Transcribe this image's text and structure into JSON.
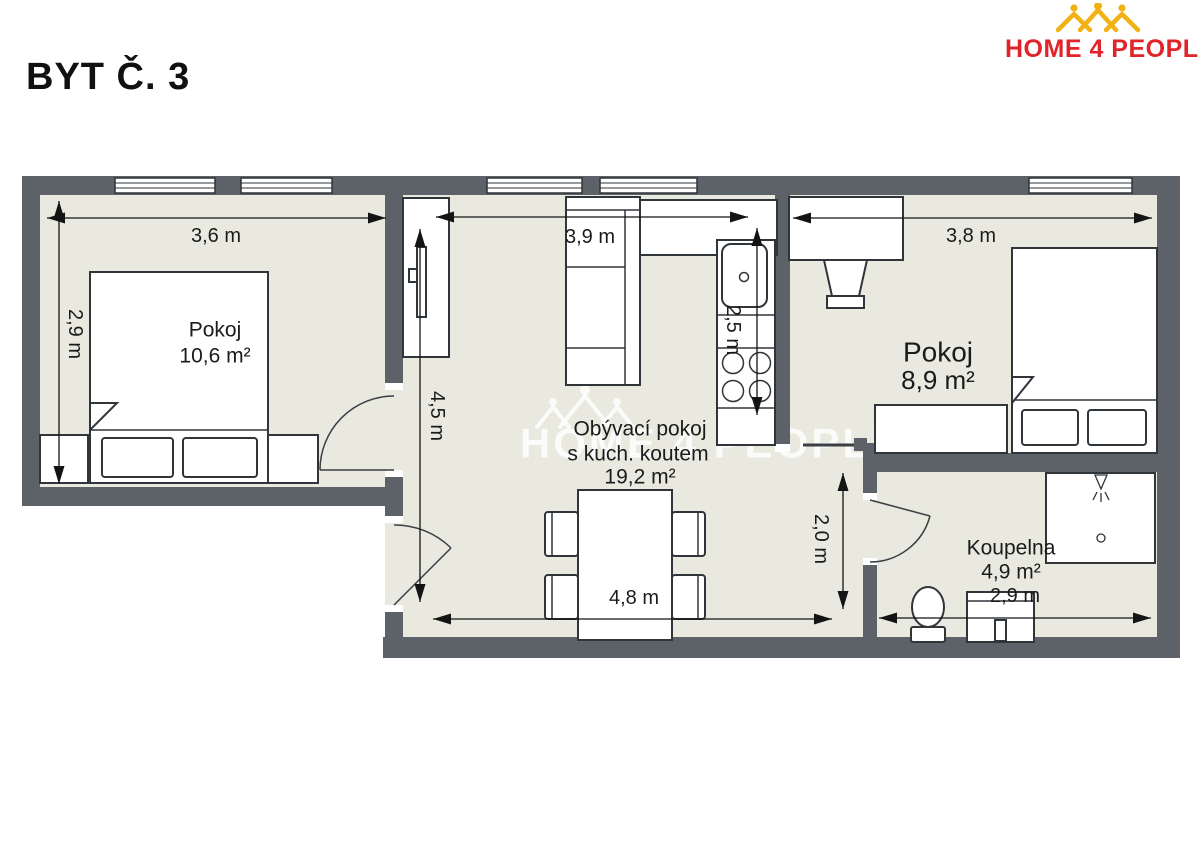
{
  "header": {
    "title": "BYT Č. 3"
  },
  "logo": {
    "text": "HOME 4 PEOPLE"
  },
  "watermark": {
    "text": "HOME 4 PEOPLE"
  },
  "rooms": {
    "bedroom1": {
      "name": "Pokoj",
      "area": "10,6 m²",
      "width_label": "3,6 m",
      "depth_label": "2,9 m"
    },
    "living": {
      "name_line1": "Obývací pokoj",
      "name_line2": "s kuch. koutem",
      "area": "19,2 m²",
      "width_top_label": "3,9 m",
      "depth_label": "4,5 m",
      "kitchen_depth_label": "2,5 m",
      "width_bottom_label": "4,8 m",
      "hall_depth_label": "2,0 m"
    },
    "bedroom2": {
      "name": "Pokoj",
      "area": "8,9 m²",
      "width_label": "3,8 m"
    },
    "bathroom": {
      "name": "Koupelna",
      "area": "4,9 m²",
      "width_label": "2,9 m"
    }
  },
  "colors": {
    "wall": "#5d6268",
    "floor": "#e9e9e0",
    "logo_red": "#e0242a",
    "logo_yellow": "#f2b215"
  }
}
